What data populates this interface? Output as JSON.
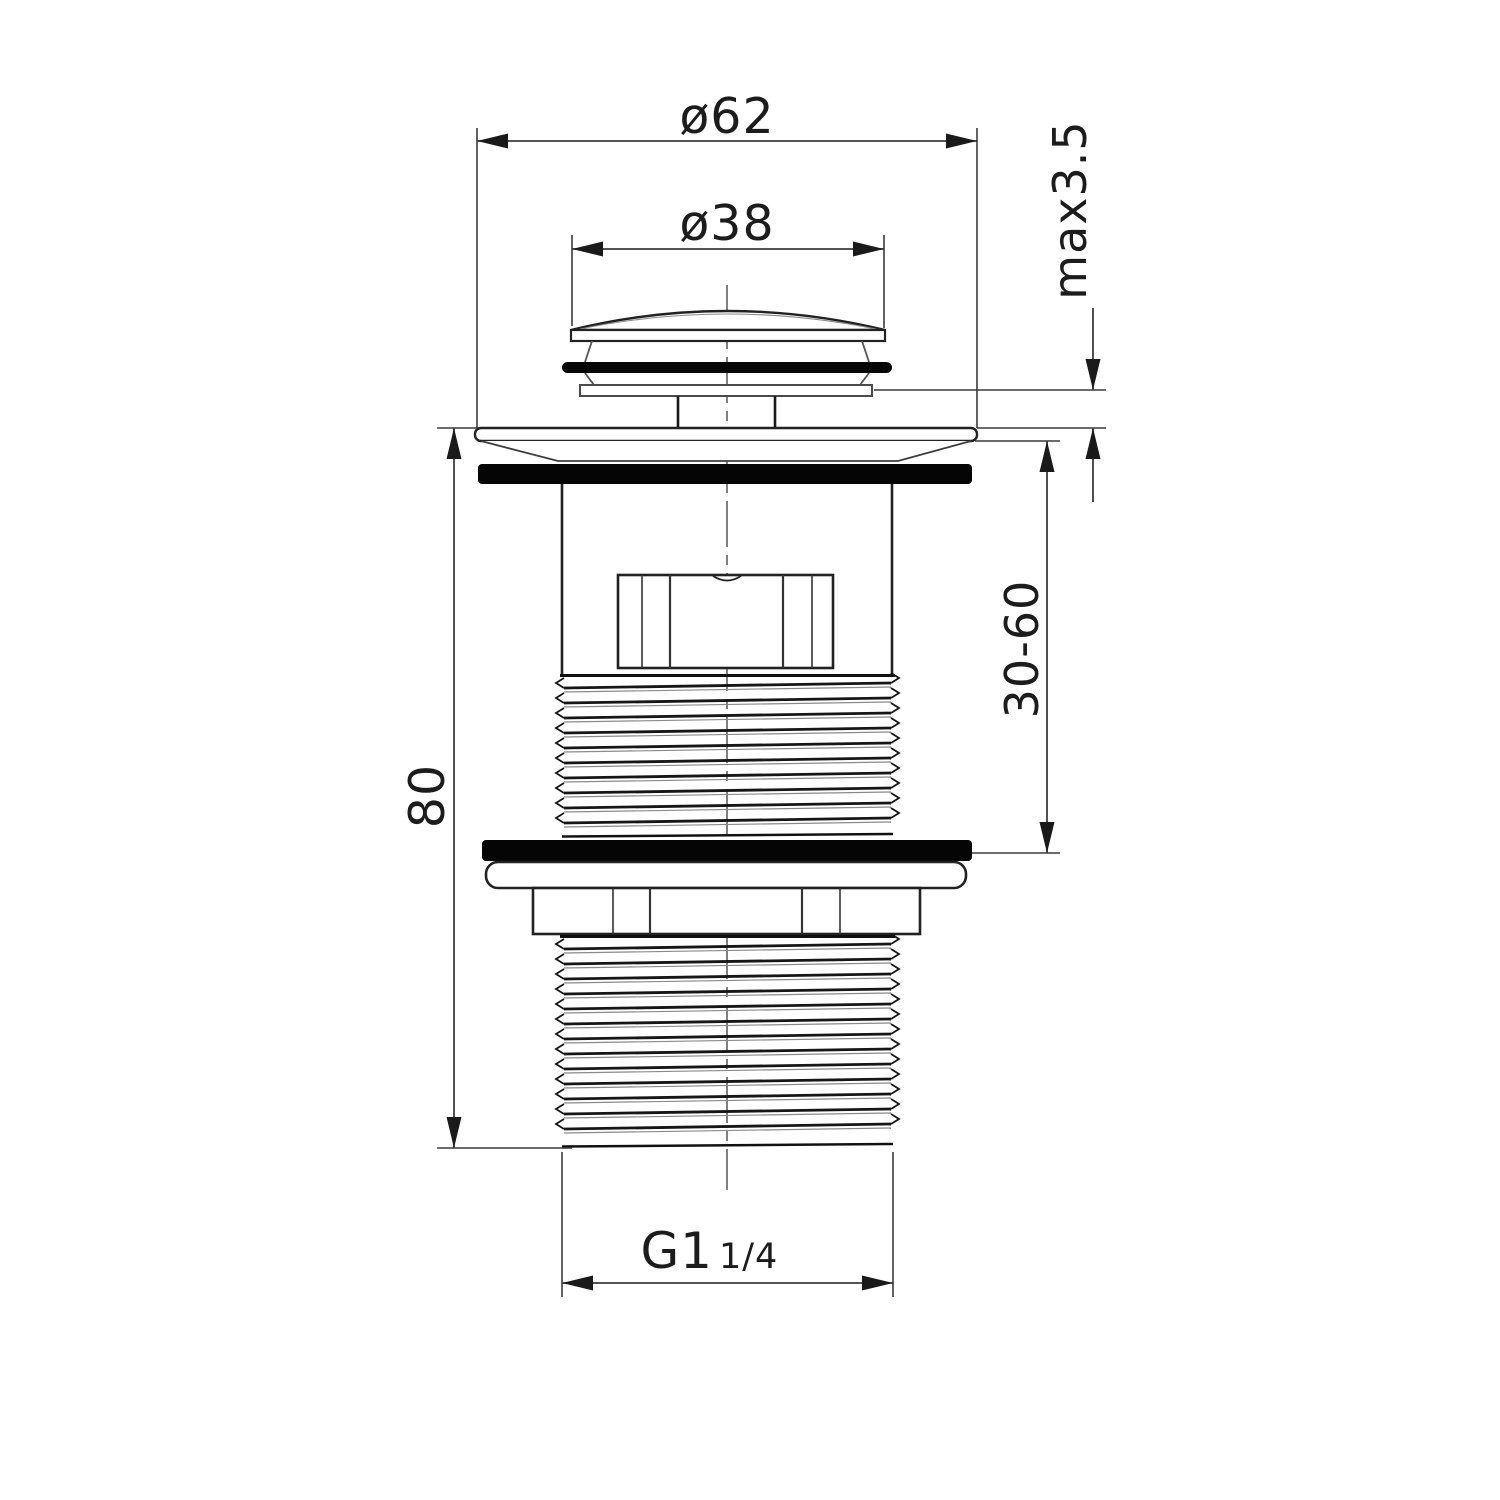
{
  "drawing": {
    "dimensions": {
      "outer_diameter": "ø62",
      "plug_diameter": "ø38",
      "max_deck_thickness": "max3.5",
      "clamping_range": "30-60",
      "overall_height": "80",
      "thread_main": "G1",
      "thread_fraction": "1/4"
    }
  }
}
